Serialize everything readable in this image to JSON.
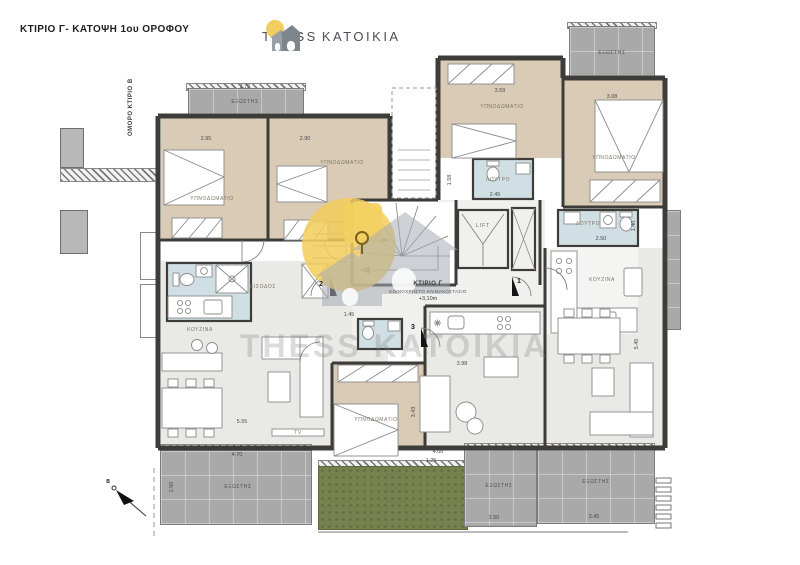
{
  "header": {
    "title": "ΚΤΙΡΙΟ Γ- ΚΑΤΟΨΗ 1ου ΟΡΟΦΟΥ",
    "adjacent_building": "ΟΜΟΡΟ ΚΤΙΡΙΟ Β"
  },
  "logo": {
    "word_left": "THESS",
    "word_right": "KATOIKIA"
  },
  "watermark": {
    "text": "THESS KATOIKIA"
  },
  "core": {
    "building": "ΚΤΙΡΙΟ Γ",
    "staircase": "ΚΟΙΝΟΧΡΗΣΤΟ ΚΛΙΜΑΚΟΣΤΑΣΙΟ",
    "level": "+3,10m",
    "lift": "LIFT",
    "north": "B",
    "doors": [
      "1",
      "2",
      "3"
    ]
  },
  "labels": {
    "bedroom": "ΥΠΝΟΔΩΜΑΤΙΟ",
    "balcony": "ΕΞΩΣΤΗΣ",
    "bath": "ΛΟΥΤΡΟ",
    "kitchen": "ΚΟΥΖΙΝΑ",
    "hall": "ΕΙΣΟΔΟΣ",
    "tv": "TV"
  },
  "dims": [
    "3.75",
    "2.95",
    "2.90",
    "3.59",
    "3.08",
    "2.45",
    "1.58",
    "2.50",
    "1.40",
    "1.45",
    "5.55",
    "4.70",
    "2.50",
    "3.98",
    "3.43",
    "4.00",
    "1.25",
    "2.50",
    "3.45",
    "5.45"
  ],
  "colors": {
    "wall": "#3e3c39",
    "bedroom_floor": "#d9cbb6",
    "bath_floor": "#cfdfe4",
    "living_floor": "#e9e9e6",
    "balcony": "#a9a9a9",
    "garden": "#76814e",
    "sun": "#f2cd60",
    "watermark_gray": "#a7adb4"
  }
}
